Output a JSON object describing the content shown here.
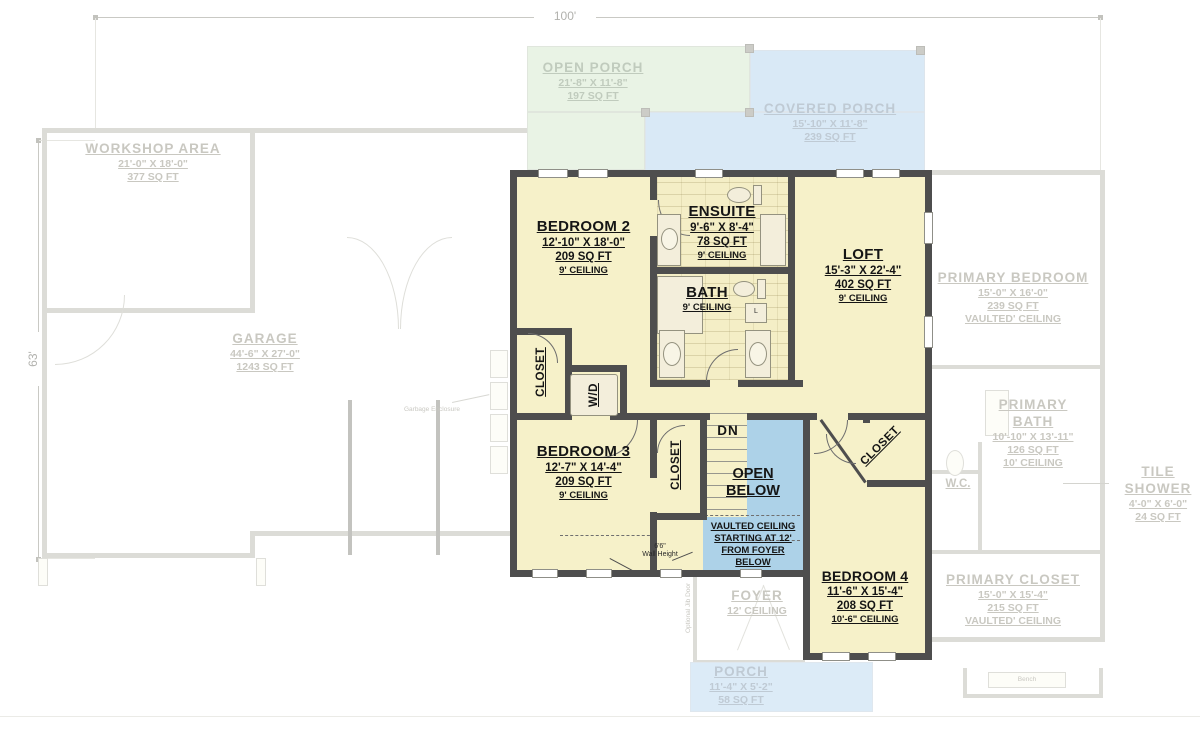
{
  "dimensions": {
    "top": "100'",
    "left": "63'"
  },
  "floor1": {
    "workshop": {
      "name": "WORKSHOP AREA",
      "size": "21'-0\" X 18'-0\"",
      "area": "377 SQ FT"
    },
    "garage": {
      "name": "GARAGE",
      "size": "44'-6\" X 27'-0\"",
      "area": "1243 SQ FT"
    },
    "open_porch": {
      "name": "OPEN PORCH",
      "size": "21'-8\" X 11'-8\"",
      "area": "197 SQ FT"
    },
    "covered_porch": {
      "name": "COVERED PORCH",
      "size": "15'-10\" X 11'-8\"",
      "area": "239 SQ FT"
    },
    "primary_bedroom": {
      "name": "PRIMARY BEDROOM",
      "size": "15'-0\" X 16'-0\"",
      "area": "239 SQ FT",
      "ceiling": "VAULTED' CEILING"
    },
    "primary_bath": {
      "name_line1": "PRIMARY",
      "name_line2": "BATH",
      "size": "10'-10\" X 13'-11\"",
      "area": "126 SQ FT",
      "ceiling": "10' CEILING"
    },
    "wc": {
      "name": "W.C."
    },
    "tile_shower": {
      "name": "TILE SHOWER",
      "size": "4'-0\" X 6'-0\"",
      "area": "24 SQ FT"
    },
    "primary_closet": {
      "name": "PRIMARY CLOSET",
      "size": "15'-0\" X 15'-4\"",
      "area": "215 SQ FT",
      "ceiling": "VAULTED' CEILING"
    },
    "foyer": {
      "name": "FOYER",
      "ceiling": "12' CEILING"
    },
    "porch": {
      "name": "PORCH",
      "size": "11'-4\" X 5'-2\"",
      "area": "58 SQ FT"
    },
    "bench": "Bench",
    "garbage_enclosure": "Garbage Enclosure",
    "optional_jib_door": "Optional Jib Door"
  },
  "floor2": {
    "bedroom2": {
      "name": "BEDROOM 2",
      "size": "12'-10\" X 18'-0\"",
      "area": "209 SQ FT",
      "ceiling": "9' CEILING"
    },
    "ensuite": {
      "name": "ENSUITE",
      "size": "9'-6\" X 8'-4\"",
      "area": "78 SQ FT",
      "ceiling": "9' CEILING"
    },
    "bath": {
      "name": "BATH",
      "ceiling": "9' CEILING"
    },
    "loft": {
      "name": "LOFT",
      "size": "15'-3\" X 22'-4\"",
      "area": "402 SQ FT",
      "ceiling": "9' CEILING"
    },
    "bedroom3": {
      "name": "BEDROOM 3",
      "size": "12'-7\" X 14'-4\"",
      "area": "209 SQ FT",
      "ceiling": "9' CEILING"
    },
    "bedroom4": {
      "name": "BEDROOM 4",
      "size": "11'-6\" X 15'-4\"",
      "area": "208 SQ FT",
      "ceiling": "10'-6\" CEILING"
    },
    "closet_bedroom2": "CLOSET",
    "closet_bedroom3": "CLOSET",
    "closet_bedroom4": "CLOSET",
    "wd": "W/D",
    "dn": "DN",
    "linen": "L",
    "open_below": {
      "line1": "OPEN",
      "line2": "BELOW",
      "note_line1": "VAULTED CEILING",
      "note_line2": "STARTING AT 12'",
      "note_line3": "FROM FOYER",
      "note_line4": "BELOW"
    },
    "wall_height": {
      "line1": "6'6\"",
      "line2": "Wall Height"
    }
  },
  "colors": {
    "wall": "#4e4e4e",
    "room_fill": "#f6f1c9",
    "open_below_fill": "#add2e8",
    "porch_green": "#e9f3e5",
    "porch_blue": "#d9e9f6",
    "faded_line": "#dcdcd7",
    "faded_text": "#c9c8c1",
    "dim_text": "#b1b1ad"
  }
}
